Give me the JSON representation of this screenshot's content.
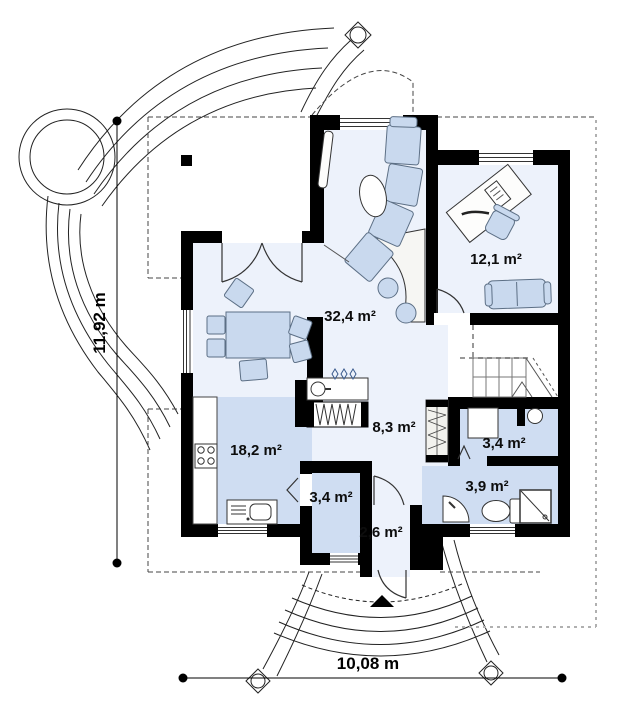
{
  "plan": {
    "rooms": {
      "living": {
        "label": "32,4 m²"
      },
      "office": {
        "label": "12,1 m²"
      },
      "kitchen": {
        "label": "18,2 m²"
      },
      "hall": {
        "label": "8,3 m²"
      },
      "utility": {
        "label": "3,4 m²"
      },
      "bathroom": {
        "label": "3,9 m²"
      },
      "pantry": {
        "label": "3,4 m²"
      },
      "vestibule": {
        "label": "2,6 m²"
      }
    },
    "dimensions": {
      "width": "10,08 m",
      "height": "11,92 m"
    },
    "colors": {
      "wall": "#000000",
      "room_light": "#edf2fb",
      "room_shaded": "#cfddf2",
      "furniture": "#c9d9ee"
    }
  }
}
